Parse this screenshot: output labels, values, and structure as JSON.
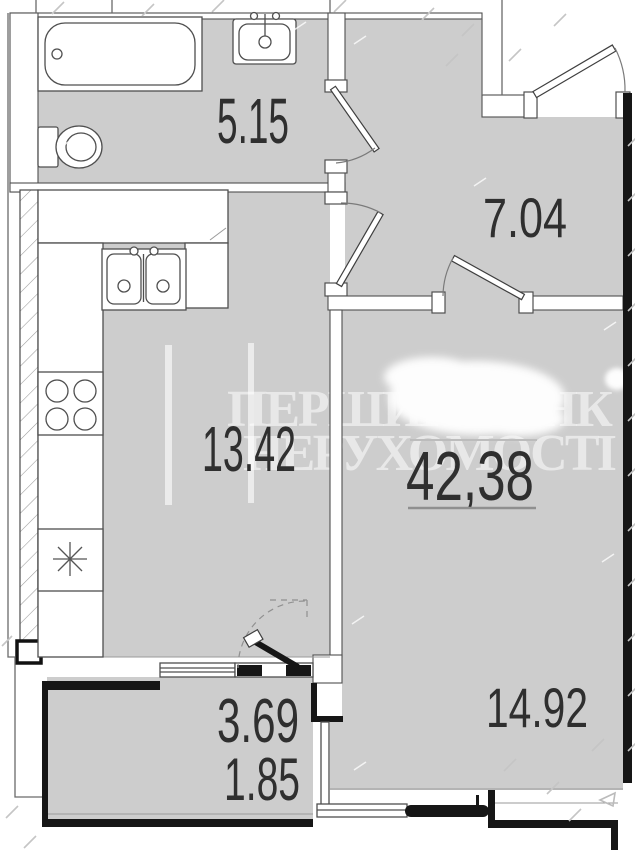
{
  "title": "Apartment floor plan",
  "watermark": {
    "line1": "ПЕРШИЙ БАНК",
    "line2": "НЕРУХОМОСТІ"
  },
  "rooms": [
    {
      "name": "bathroom",
      "area": "5.15"
    },
    {
      "name": "hallway",
      "area": "7.04"
    },
    {
      "name": "kitchen-living",
      "area": "13.42"
    },
    {
      "name": "total-area",
      "area": "42,38"
    },
    {
      "name": "bedroom",
      "area": "14.92"
    },
    {
      "name": "balcony-area-1",
      "area": "3.69"
    },
    {
      "name": "balcony-area-2",
      "area": "1.85"
    }
  ],
  "colors": {
    "floor": "#cdcdcd",
    "wallLine": "#4f4f4f",
    "wallDark": "#161616",
    "label": "#2f2f2f",
    "watermark": "rgba(255,255,255,0.55)",
    "tick": "#c5c5c5"
  }
}
